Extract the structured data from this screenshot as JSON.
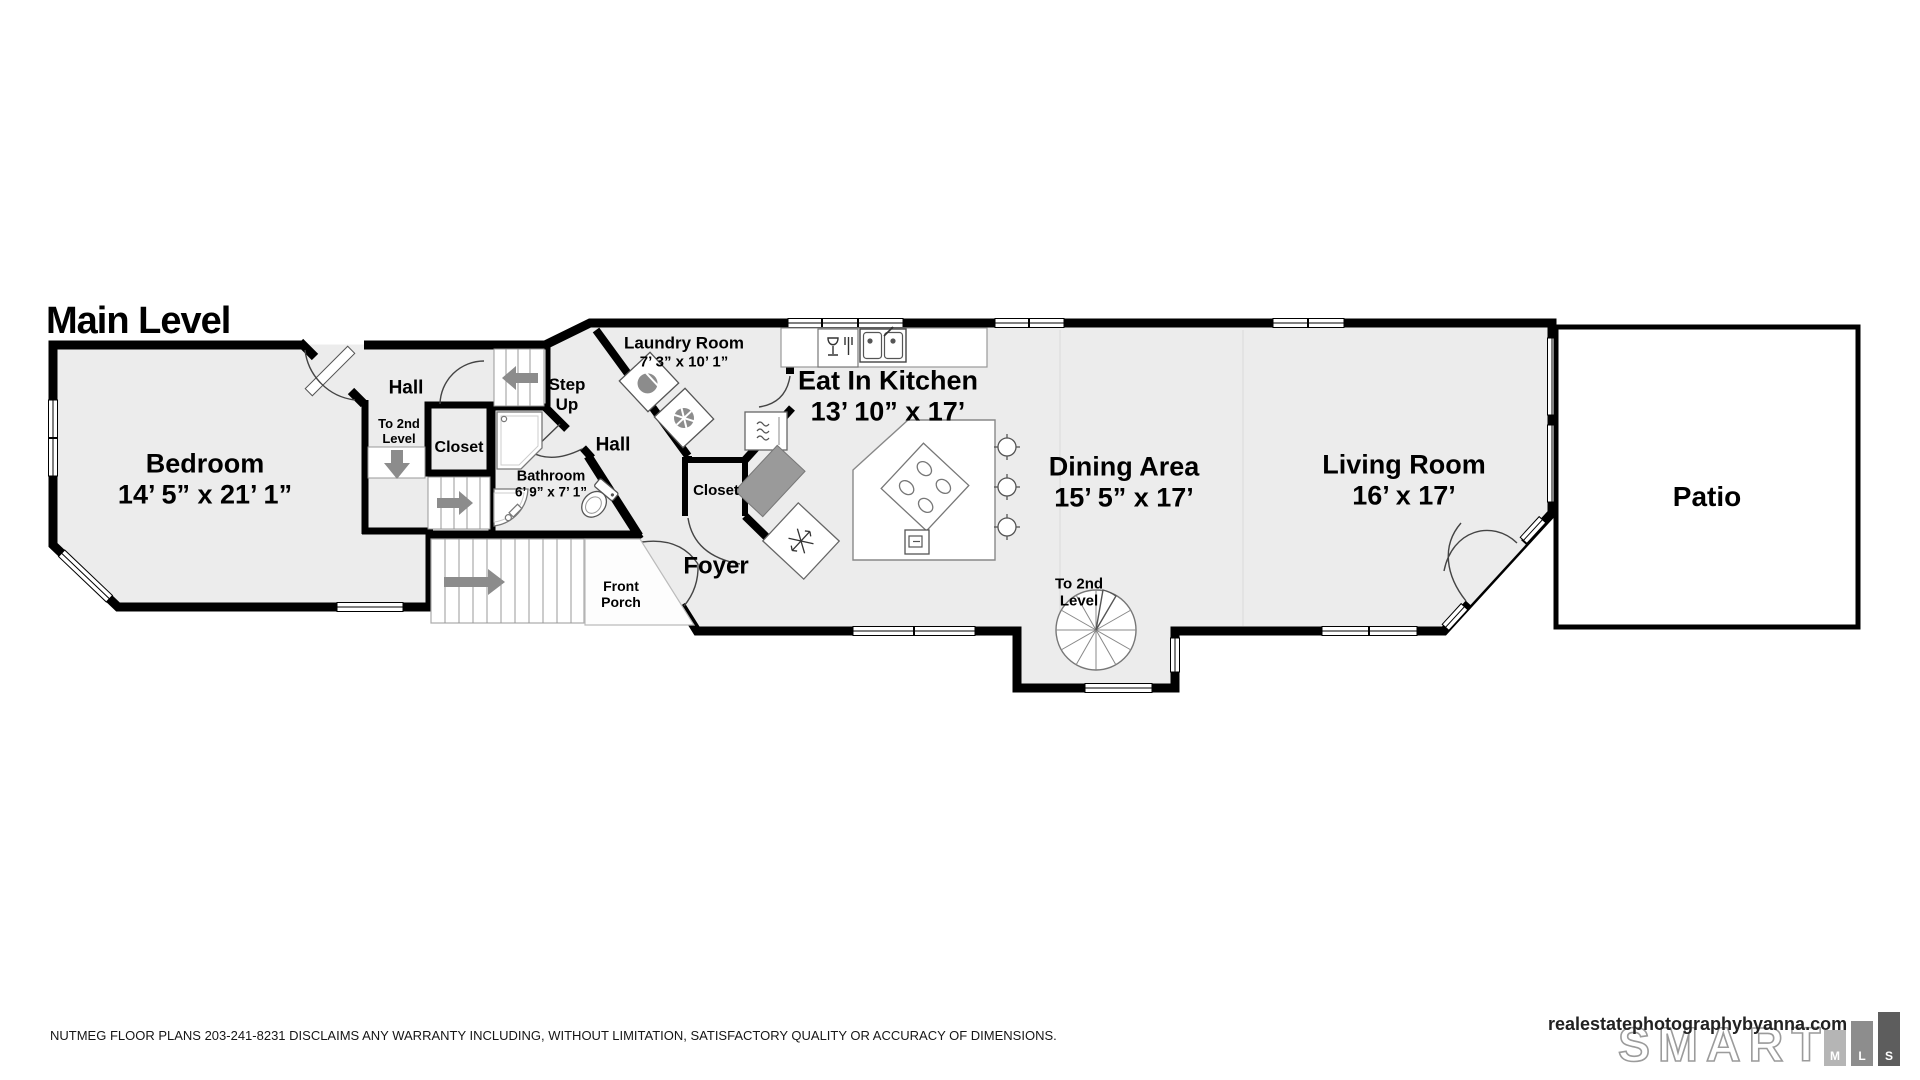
{
  "title": "Main Level",
  "rooms": {
    "bedroom": {
      "name": "Bedroom",
      "dims": "14’ 5” x 21’ 1”"
    },
    "hall_upper": {
      "name": "Hall"
    },
    "to2_hall": {
      "name": "To 2nd\nLevel"
    },
    "closet_hall": {
      "name": "Closet"
    },
    "step_up": {
      "name": "Step\nUp"
    },
    "laundry": {
      "name": "Laundry Room",
      "dims": "7’ 3” x 10’ 1”"
    },
    "hall_lower": {
      "name": "Hall"
    },
    "bathroom": {
      "name": "Bathroom",
      "dims": "6’ 9” x 7’ 1”"
    },
    "closet_foyer": {
      "name": "Closet"
    },
    "foyer": {
      "name": "Foyer"
    },
    "front_porch": {
      "name": "Front\nPorch"
    },
    "kitchen": {
      "name": "Eat In Kitchen",
      "dims": "13’ 10” x 17’"
    },
    "dining": {
      "name": "Dining Area",
      "dims": "15’ 5” x 17’"
    },
    "to2_spiral": {
      "name": "To 2nd\nLevel"
    },
    "living": {
      "name": "Living Room",
      "dims": "16’ x 17’"
    },
    "patio": {
      "name": "Patio"
    }
  },
  "footer": {
    "disclaimer": "NUTMEG FLOOR PLANS 203-241-8231 DISCLAIMS ANY WARRANTY INCLUDING, WITHOUT LIMITATION, SATISFACTORY QUALITY OR ACCURACY OF DIMENSIONS.",
    "brand": "realestatephotographybyanna.com",
    "logo_word": "SMART",
    "logo_letters": {
      "m": "M",
      "l": "L",
      "s": "S"
    }
  },
  "colors": {
    "wall": "#000000",
    "floor": "#ececec",
    "arrow": "#8c8c8c",
    "counter": "#9a9a9a"
  }
}
